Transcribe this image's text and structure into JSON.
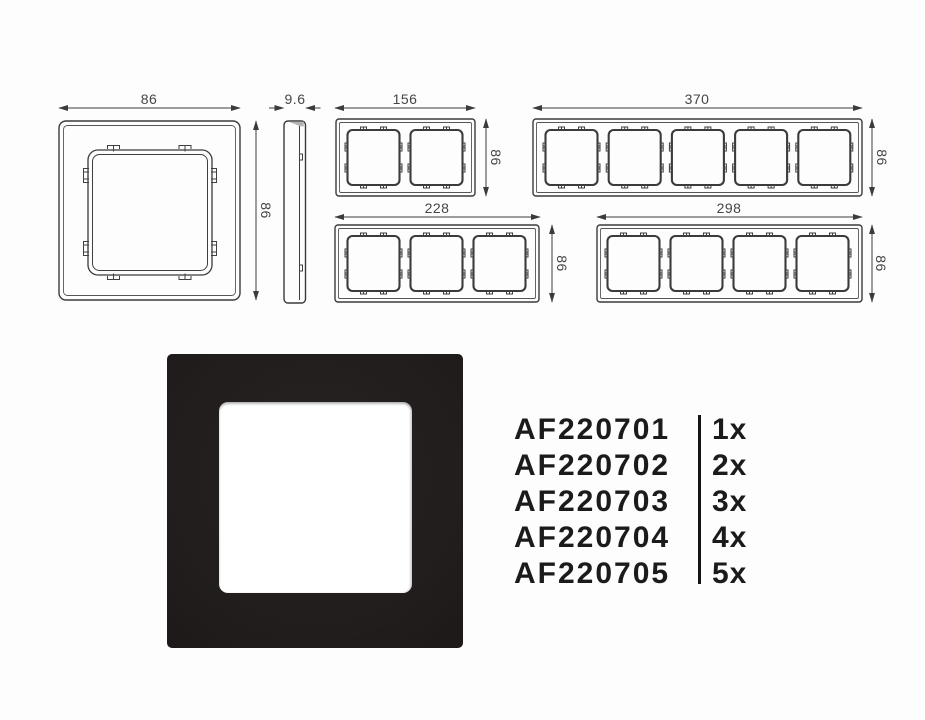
{
  "dimensions": {
    "single_width": "86",
    "single_height": "86",
    "depth": "9.6",
    "gang2_width": "156",
    "gang2_height": "86",
    "gang3_width": "228",
    "gang3_height": "86",
    "gang4_width": "298",
    "gang4_height": "86",
    "gang5_width": "370",
    "gang5_height": "86"
  },
  "codes": {
    "rows": [
      {
        "code": "AF220701",
        "qty": "1x"
      },
      {
        "code": "AF220702",
        "qty": "2x"
      },
      {
        "code": "AF220703",
        "qty": "3x"
      },
      {
        "code": "AF220704",
        "qty": "4x"
      },
      {
        "code": "AF220705",
        "qty": "5x"
      }
    ]
  },
  "colors": {
    "drawing_line": "#3b3b3b",
    "dimension_text": "#454545",
    "code_text": "#1b1b1b",
    "frame_black": "#241f1f",
    "background": "#fdfdfd"
  }
}
